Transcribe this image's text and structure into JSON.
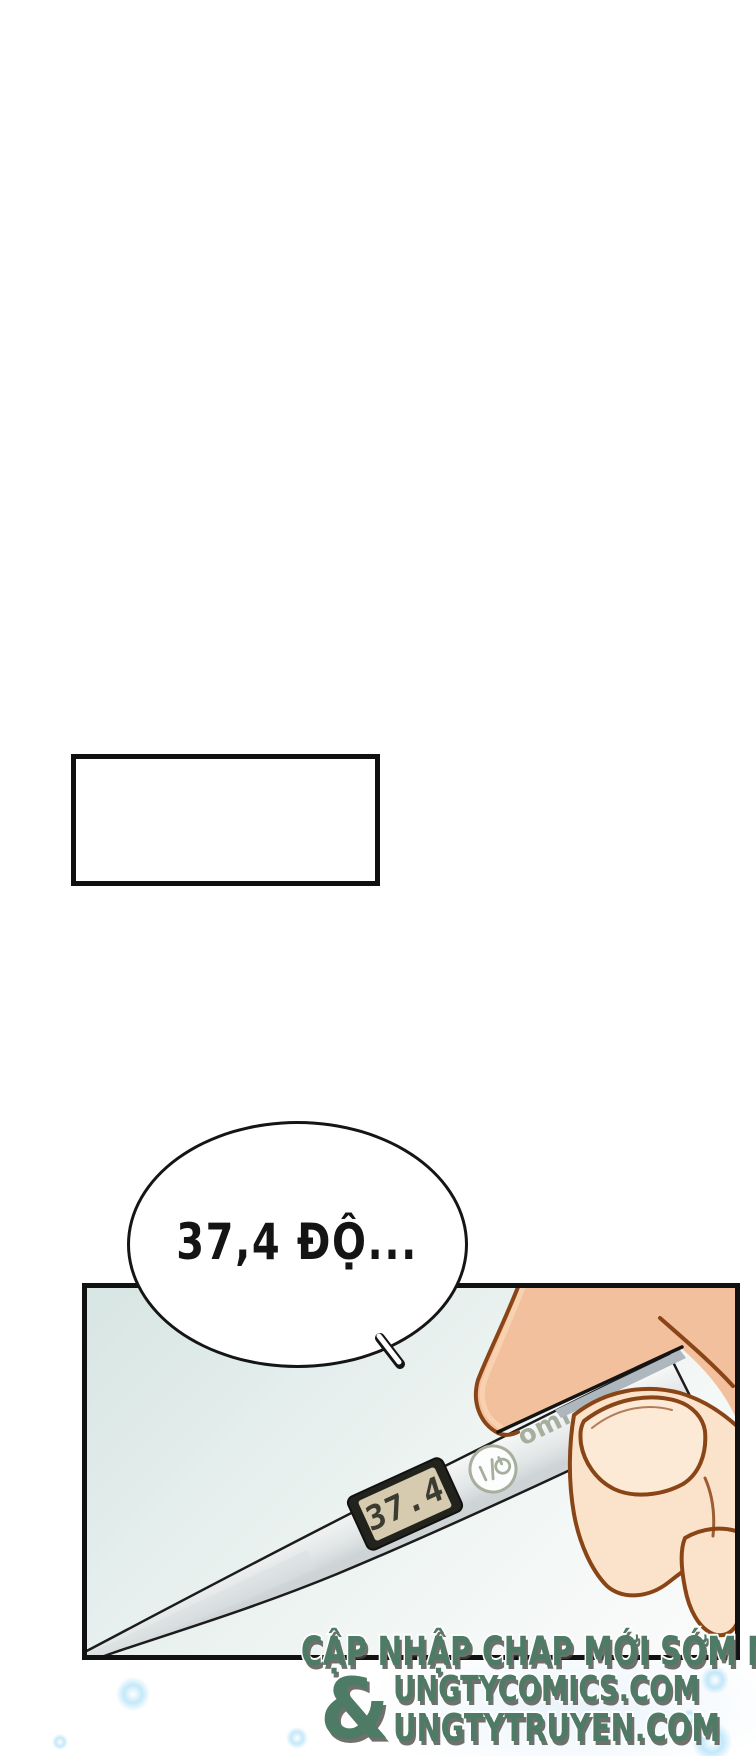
{
  "speech_bubble": {
    "text": "37,4 ĐỘ..."
  },
  "panel": {
    "thermometer": {
      "display_value": "37.4",
      "brand_visible": "omr",
      "power_icon": "power-toggle-symbol"
    }
  },
  "watermark": {
    "line1": "CẬP NHẬP CHAP MỚI SỚM NHẤT TẠI",
    "ampersand": "&",
    "site1": "UNGTYCOMICS.COM",
    "site2": "UNGTYTRUYEN.COM"
  },
  "colors": {
    "ink": "#151515",
    "outline_brown": "#8a4516",
    "skin_thumb": "#f3c09d",
    "skin_thumb_highlight": "#f8d4b2",
    "skin_finger": "#fbe3cb",
    "nail": "#fce9d6",
    "probe_gray": "#adb7bd",
    "lcd_frame": "#23231e",
    "lcd_screen": "#d6caaf",
    "lcd_digits": "#3c3b32",
    "device_accent_green": "#a6af9d",
    "watermark_green": "#4e7b66",
    "panel_bg": "#d7e5e3"
  }
}
